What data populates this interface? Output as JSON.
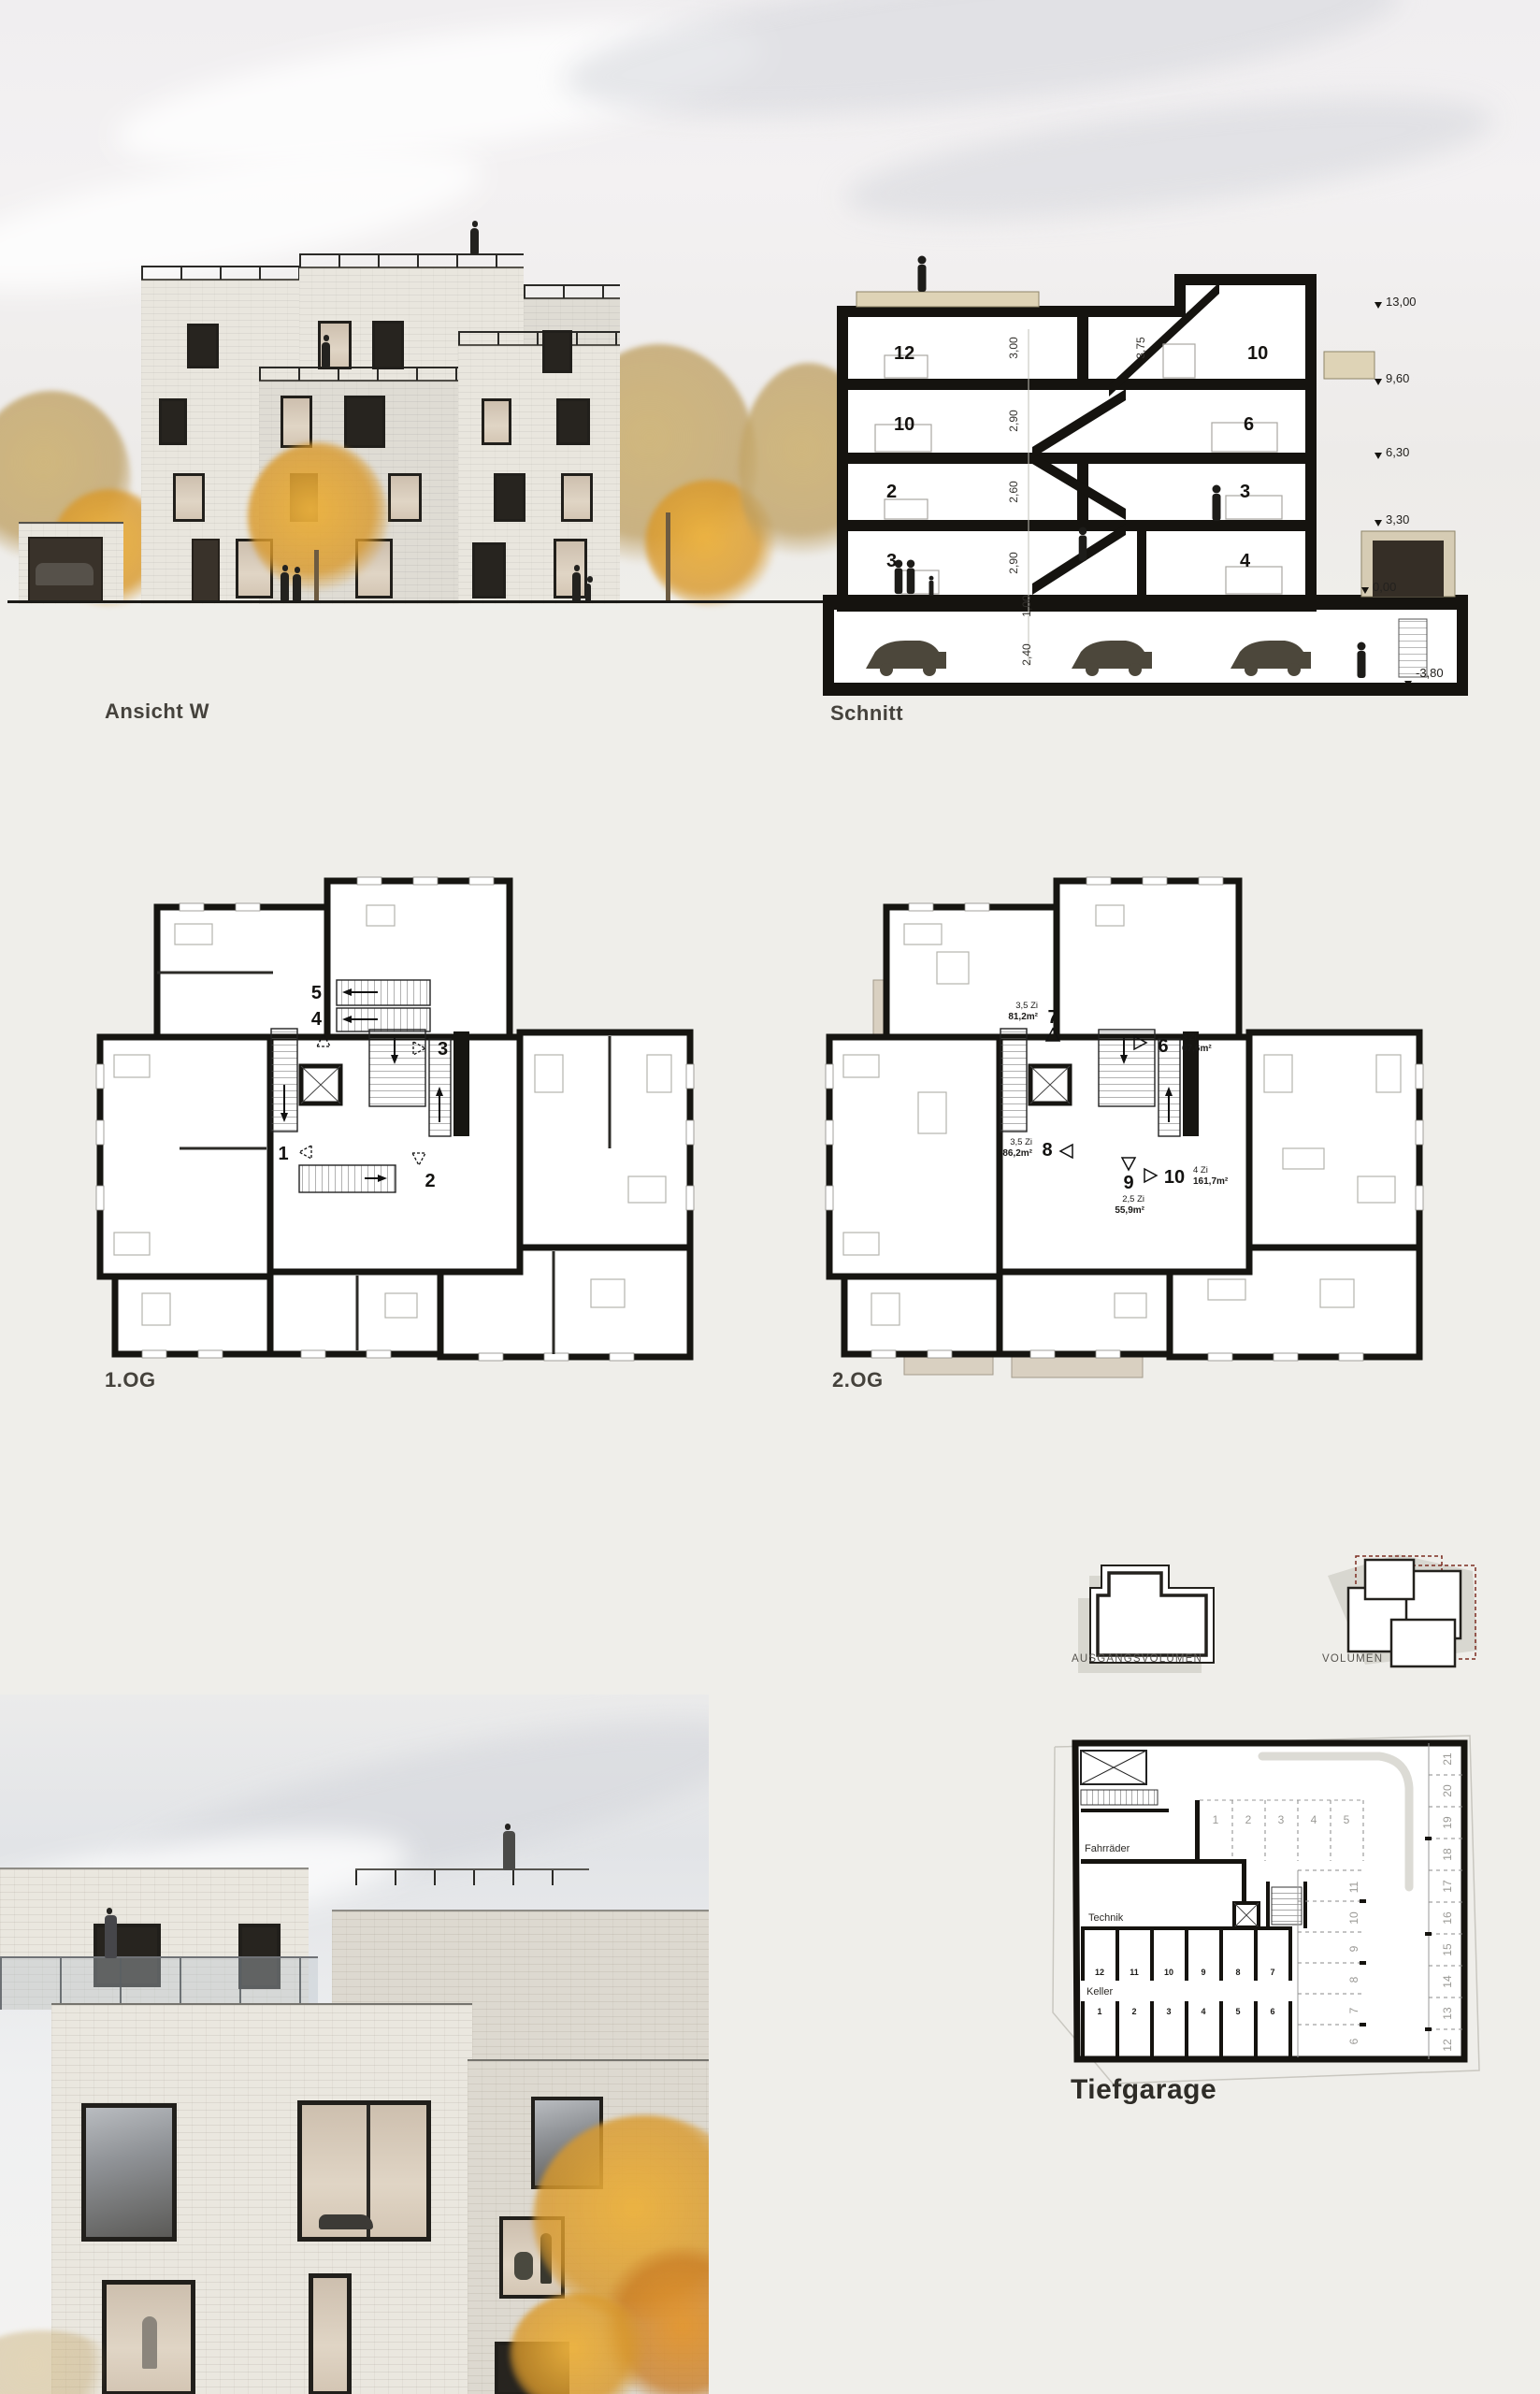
{
  "board": {
    "title_ansicht": "Ansicht W",
    "title_schnitt": "Schnitt",
    "title_og1": "1.OG",
    "title_og2": "2.OG",
    "title_ausgangsvolumen": "AUSGANGSVOLUMEN",
    "title_volumen": "VOLUMEN",
    "title_tiefgarage": "Tiefgarage"
  },
  "section": {
    "rooms": {
      "top_left": "12",
      "top_right": "10",
      "f2_left": "10",
      "f2_right": "6",
      "f1_left": "2",
      "f1_right": "3",
      "f0_left": "3",
      "f0_right": "4"
    },
    "heights": {
      "top_left": "3,00",
      "top_stair": "3,75",
      "f2": "2,90",
      "f1": "2,60",
      "f0": "2,90",
      "slab": "1,00",
      "garage": "2,40"
    },
    "levels": [
      "13,00",
      "9,60",
      "6,30",
      "3,30",
      "0,00",
      "-3,80"
    ]
  },
  "plan_og1": {
    "units": [
      "1",
      "2",
      "3",
      "4",
      "5"
    ]
  },
  "plan_og2": {
    "units": [
      {
        "no": "6",
        "rooms": "3 Zi",
        "area": "67,6m²"
      },
      {
        "no": "7",
        "rooms": "3,5 Zi",
        "area": "81,2m²"
      },
      {
        "no": "8",
        "rooms": "3,5 Zi",
        "area": "86,2m²"
      },
      {
        "no": "9",
        "rooms": "2,5 Zi",
        "area": "55,9m²"
      },
      {
        "no": "10",
        "rooms": "4 Zi",
        "area": "161,7m²"
      }
    ]
  },
  "garage": {
    "room_fahrraeder": "Fahrräder",
    "room_technik": "Technik",
    "room_keller": "Keller",
    "stalls_top": [
      "1",
      "2",
      "3",
      "4",
      "5"
    ],
    "stalls_mid": [
      "11",
      "10",
      "9",
      "8",
      "7",
      "6"
    ],
    "stalls_right": [
      "21",
      "20",
      "19",
      "18",
      "17",
      "16",
      "15",
      "14",
      "13",
      "12"
    ],
    "keller_row_top": [
      "12",
      "11",
      "10",
      "9",
      "8",
      "7"
    ],
    "keller_row_bottom": [
      "1",
      "2",
      "3",
      "4",
      "5",
      "6"
    ]
  },
  "colors": {
    "accent_red": "#7c2b20",
    "tree_yellow": "#dfa93c",
    "brick": "#e9e6de",
    "ink": "#1c1b18"
  }
}
